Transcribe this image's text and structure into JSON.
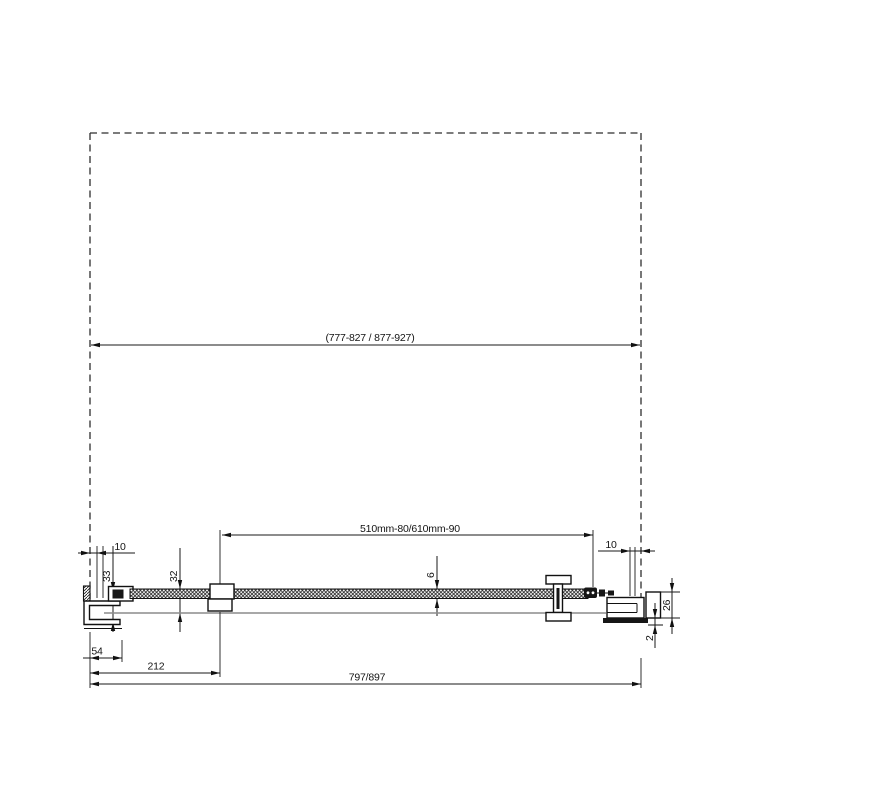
{
  "drawing": {
    "kind": "shower-door-section-technical-drawing",
    "colors": {
      "line": "#1a1a1a",
      "secondary_line": "#8c8c8c",
      "background": "#ffffff"
    },
    "dimensions": {
      "opening_width": "(777-827 / 877-927)",
      "glass_width": "510mm-80/610mm-90",
      "left_wall_gap": "10",
      "right_wall_gap": "10",
      "left_profile_depth": "33",
      "panel_offset": "32",
      "glass_thickness": "6",
      "right_profile_depth": "26",
      "adjustment_gap": "2",
      "fixed_part_offset": "54",
      "clamp_position": "212",
      "total_width": "797/897"
    }
  }
}
